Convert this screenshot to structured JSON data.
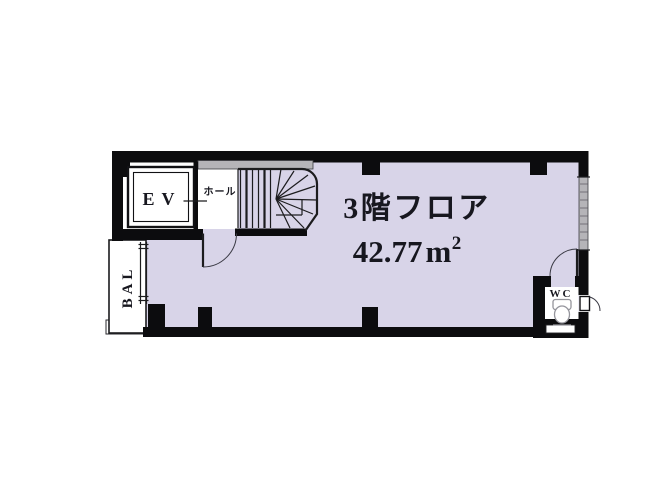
{
  "plan": {
    "floor_label": "3階フロア",
    "area": {
      "value": "42.77",
      "unit": "m",
      "exponent": "2",
      "display": "42.77㎡"
    },
    "rooms": {
      "elevator_label": "EV",
      "hall_label": "ホール",
      "balcony_label": "BAL",
      "wc_label": "WC"
    },
    "colors": {
      "floor_fill": "#d8d4e8",
      "wall": "#0c0c0e",
      "window_fill": "#b5b4b8",
      "line": "#1c1c1e",
      "text": "#17171f",
      "toilet": "#95959c"
    }
  }
}
